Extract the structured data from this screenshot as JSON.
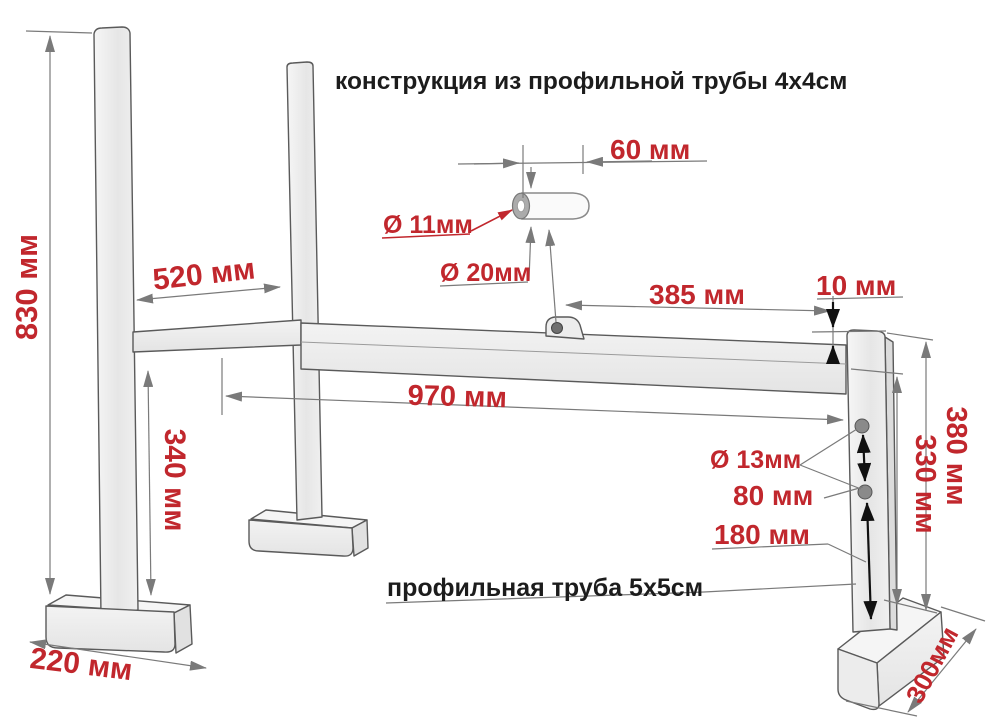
{
  "title": "конструкция из профильной трубы 4х4см",
  "material_note": "профильная труба 5х5см",
  "colors": {
    "dimension_red": "#c1272d",
    "text_black": "#1c1c1c",
    "line_gray": "#7a7a7a",
    "tube_fill": "#efefef",
    "arrow_black": "#111111"
  },
  "dimensions": {
    "left_post_height": "830 мм",
    "post_spacing": "520 мм",
    "pin_length": "60 мм",
    "pin_hole_diameter": "Ø 11мм",
    "pin_diameter": "Ø 20мм",
    "lug_to_front_post": "385 мм",
    "post_top_offset": "10 мм",
    "beam_length": "970 мм",
    "middle_post_height": "340 мм",
    "front_post_height": "380 мм",
    "front_post_to_beam": "330 мм",
    "holes_diameter": "Ø 13мм",
    "holes_spacing": "80 мм",
    "lower_hole_offset": "180 мм",
    "left_foot_length": "220 мм",
    "front_foot_length": "300мм"
  }
}
